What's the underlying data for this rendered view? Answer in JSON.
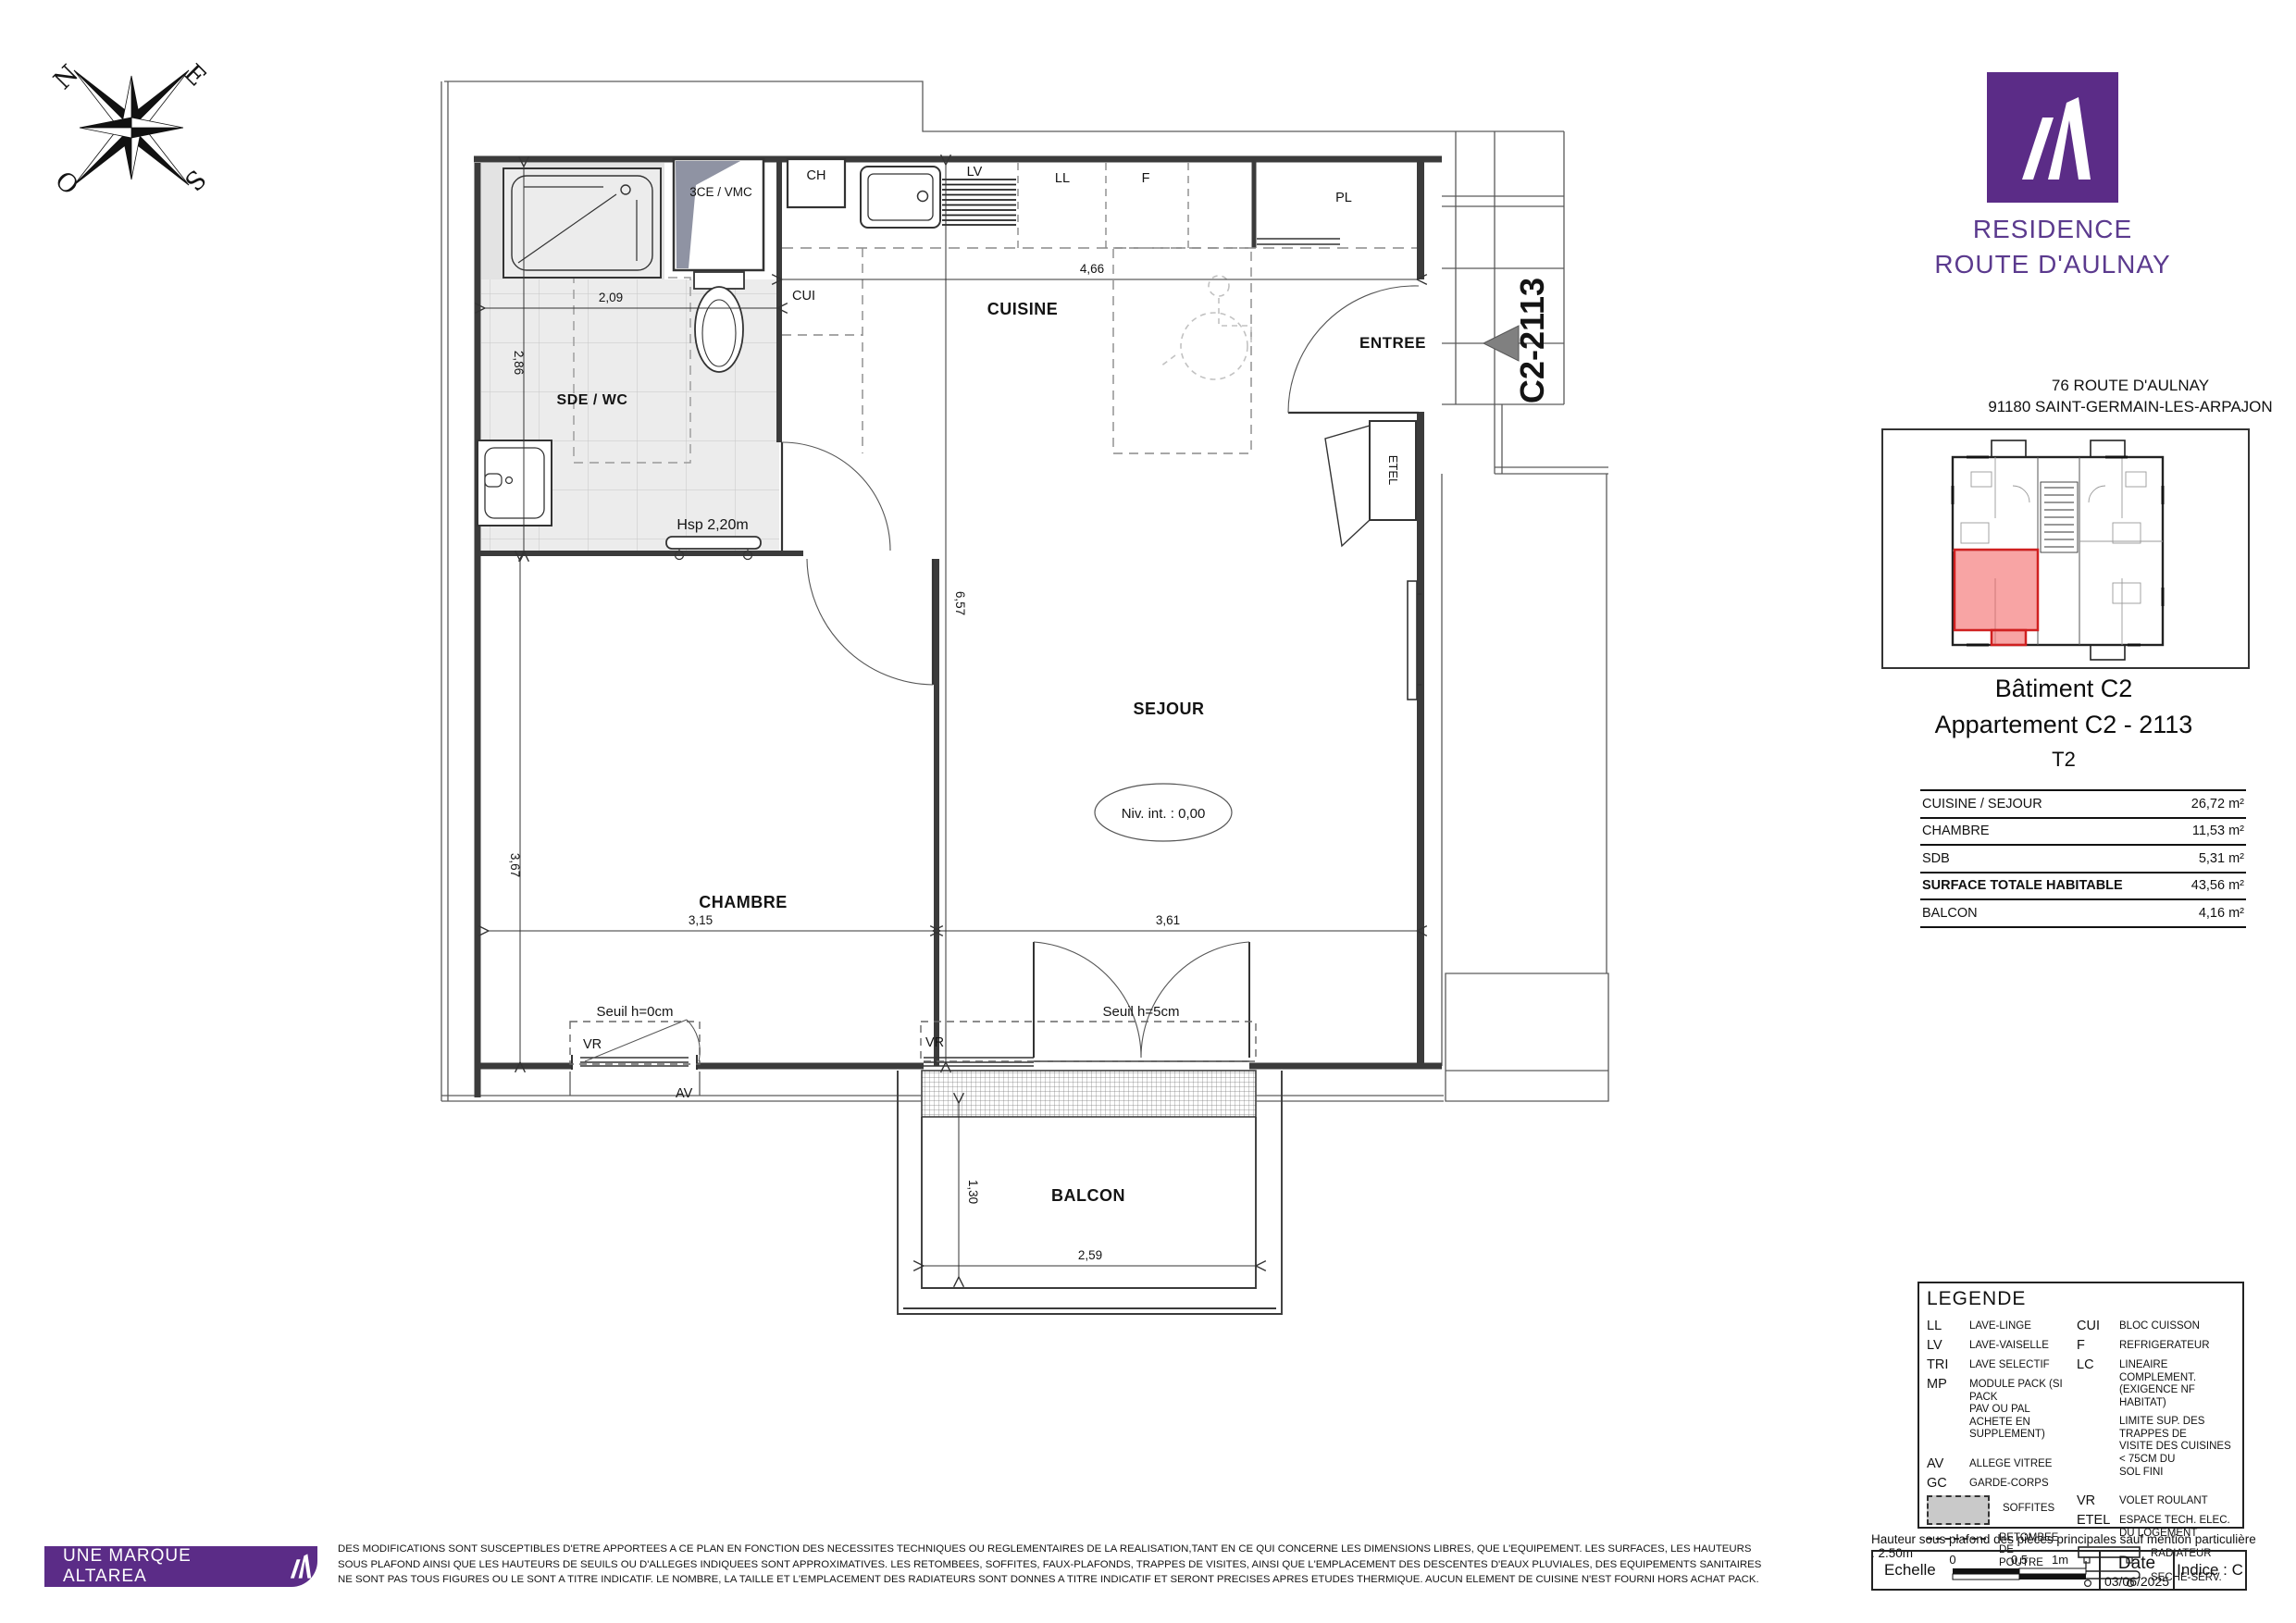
{
  "colors": {
    "brand_purple": "#5b2c87",
    "brand_text_purple": "#5b3a8e",
    "highlight_red": "#e84b4b",
    "soffit_gray": "#c9c9c9",
    "wall_gray": "#3b3b3b"
  },
  "compass": {
    "n": "N",
    "e": "E",
    "s": "S",
    "o": "O"
  },
  "plan": {
    "unit_ref": "C2-2113",
    "rooms": {
      "sde": "SDE / WC",
      "cuisine": "CUISINE",
      "entree": "ENTREE",
      "sejour": "SEJOUR",
      "chambre": "CHAMBRE",
      "balcon": "BALCON"
    },
    "labels": {
      "shaft": "3CE / VMC",
      "ch": "CH",
      "lv": "LV",
      "ll": "LL",
      "f": "F",
      "pl": "PL",
      "cui": "CUI",
      "etel": "ETEL",
      "hsp": "Hsp 2,20m",
      "niv": "Niv. int. : 0,00",
      "seuil0": "Seuil h=0cm",
      "seuil5": "Seuil h=5cm",
      "vr": "VR",
      "av": "AV"
    },
    "dims": {
      "sde_w": "2,09",
      "sde_d": "2,86",
      "kitchen_w": "4,66",
      "depth": "6,57",
      "chambre_d": "3,67",
      "chambre_w": "3,15",
      "sejour_w": "3,61",
      "balcon_d": "1,30",
      "balcon_w": "2,59"
    }
  },
  "panel": {
    "brand_line1": "RESIDENCE",
    "brand_line2": "ROUTE D'AULNAY",
    "address_line1": "76 ROUTE D'AULNAY",
    "address_line2": "91180 SAINT-GERMAIN-LES-ARPAJON",
    "building": "Bâtiment C2",
    "apartment": "Appartement C2 - 2113",
    "type": "T2",
    "surfaces": [
      {
        "label": "CUISINE / SEJOUR",
        "value": "26,72 m²"
      },
      {
        "label": "CHAMBRE",
        "value": "11,53 m²"
      },
      {
        "label": "SDB",
        "value": "5,31 m²"
      },
      {
        "label": "SURFACE TOTALE HABITABLE",
        "value": "43,56 m²"
      },
      {
        "label": "BALCON",
        "value": "4,16 m²"
      }
    ]
  },
  "legend": {
    "title": "LEGENDE",
    "left": [
      {
        "abbr": "LL",
        "label": "LAVE-LINGE"
      },
      {
        "abbr": "LV",
        "label": "LAVE-VAISELLE"
      },
      {
        "abbr": "TRI",
        "label": "LAVE SELECTIF"
      },
      {
        "abbr": "MP",
        "label": "MODULE PACK (SI PACK\nPAV OU PAL ACHETE EN\nSUPPLEMENT)"
      },
      {
        "abbr": "AV",
        "label": "ALLEGE VITREE"
      },
      {
        "abbr": "GC",
        "label": "GARDE-CORPS"
      }
    ],
    "right": [
      {
        "abbr": "CUI",
        "label": "BLOC CUISSON"
      },
      {
        "abbr": "F",
        "label": "REFRIGERATEUR"
      },
      {
        "abbr": "LC",
        "label": "LINEAIRE COMPLEMENT.\n(EXIGENCE NF HABITAT)"
      },
      {
        "abbr": "",
        "label": "LIMITE SUP. DES TRAPPES DE\nVISITE DES CUISINES < 75CM DU\nSOL FINI"
      },
      {
        "abbr": "VR",
        "label": "VOLET ROULANT"
      },
      {
        "abbr": "ETEL",
        "label": "ESPACE TECH. ELEC.\nDU LOGEMENT"
      }
    ],
    "soffites": "SOFFITES",
    "retombee": "RETOMBEE DE\nPOUTRE",
    "radiateur": "RADIATEUR",
    "seche": "SECHE-SERV."
  },
  "footer": {
    "badge": "UNE MARQUE ALTAREA",
    "ceiling_note": "Hauteur sous plafond des pièces principales sauf mention particulière : 2.50m",
    "echelle": "Echelle",
    "scale_0": "0",
    "scale_05": "0.5",
    "scale_1": "1m",
    "date_label": "Date",
    "date_value": "03/06/2025",
    "indice": "Indice : C",
    "disclaimer_line1": "DES MODIFICATIONS SONT SUSCEPTIBLES D'ETRE APPORTEES A CE PLAN EN FONCTION DES NECESSITES TECHNIQUES OU REGLEMENTAIRES DE LA REALISATION,TANT EN CE QUI CONCERNE LES DIMENSIONS LIBRES, QUE L'EQUIPEMENT. LES SURFACES, LES HAUTEURS",
    "disclaimer_line2": "SOUS PLAFOND AINSI QUE LES HAUTEURS DE SEUILS OU D'ALLEGES INDIQUEES SONT APPROXIMATIVES. LES RETOMBEES, SOFFITES, FAUX-PLAFONDS, TRAPPES DE VISITES, AINSI QUE L'EMPLACEMENT DES DESCENTES D'EAUX PLUVIALES, DES EQUIPEMENTS SANITAIRES",
    "disclaimer_line3": "NE SONT PAS TOUS FIGURES OU LE SONT A TITRE INDICATIF. LE NOMBRE, LA TAILLE ET L'EMPLACEMENT DES RADIATEURS SONT DONNES A TITRE INDICATIF ET SERONT PRECISES APRES ETUDES THERMIQUE. AUCUN ELEMENT DE CUISINE N'EST FOURNI HORS ACHAT PACK."
  }
}
